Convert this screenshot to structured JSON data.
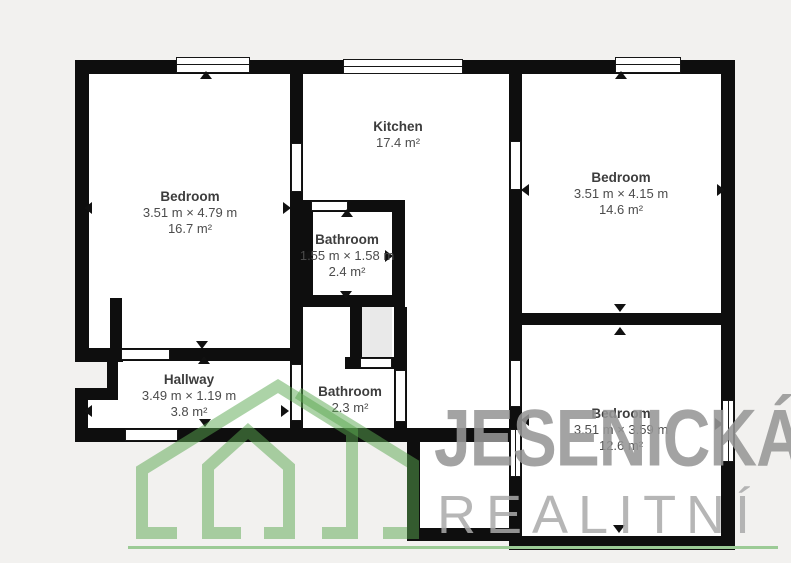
{
  "plan": {
    "rooms": [
      {
        "name": "Bedroom",
        "dims": "3.51 m × 4.79 m",
        "area": "16.7 m²"
      },
      {
        "name": "Kitchen",
        "dims": "",
        "area": "17.4 m²"
      },
      {
        "name": "Bedroom",
        "dims": "3.51 m × 4.15 m",
        "area": "14.6 m²"
      },
      {
        "name": "Bathroom",
        "dims": "1.55 m × 1.58 m",
        "area": "2.4 m²"
      },
      {
        "name": "Hallway",
        "dims": "3.49 m × 1.19 m",
        "area": "3.8 m²"
      },
      {
        "name": "Bathroom",
        "dims": "",
        "area": "2.3 m²"
      },
      {
        "name": "Bedroom",
        "dims": "3.51 m × 3.59 m",
        "area": "12.6 m²"
      }
    ]
  },
  "watermark": {
    "line1": "JESENICKÁ",
    "line2": "REALITNÍ"
  },
  "colors": {
    "background": "#f2f1ef",
    "wall": "#0e0e0e",
    "floor": "#ffffff",
    "shaft_fill": "#e9e9e9",
    "logo_green": "#5aa850",
    "underline_green": "#9ccb96",
    "watermark_gray_bold": "#969696",
    "watermark_gray_light": "#a9a9a9",
    "label_text": "#3d3d3d"
  }
}
